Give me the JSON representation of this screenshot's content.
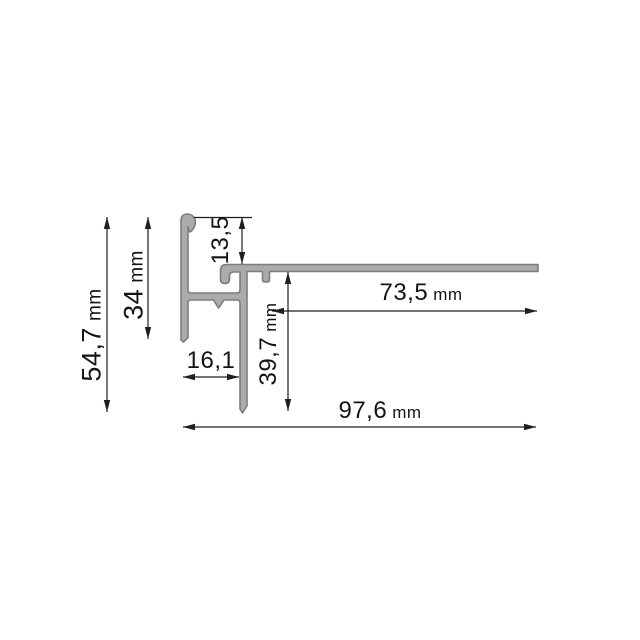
{
  "drawing": {
    "kind": "profile-cross-section-dimension-drawing",
    "unit": "mm",
    "labels": {
      "total_height": {
        "value": "54,7",
        "unit": "mm"
      },
      "left_wall_height": {
        "value": "34",
        "unit": "mm"
      },
      "top_offset": {
        "value": "13,5",
        "unit": ""
      },
      "left_width": {
        "value": "16,1",
        "unit": ""
      },
      "right_wall_height": {
        "value": "39,7",
        "unit": "mm"
      },
      "flange_length": {
        "value": "73,5",
        "unit": "mm"
      },
      "total_width": {
        "value": "97,6",
        "unit": "mm"
      }
    },
    "colors": {
      "background": "#ffffff",
      "profile_fill": "#ababab",
      "profile_outline": "#7d7d7d",
      "dimension_line": "#1f1f1f",
      "text": "#141414"
    }
  }
}
